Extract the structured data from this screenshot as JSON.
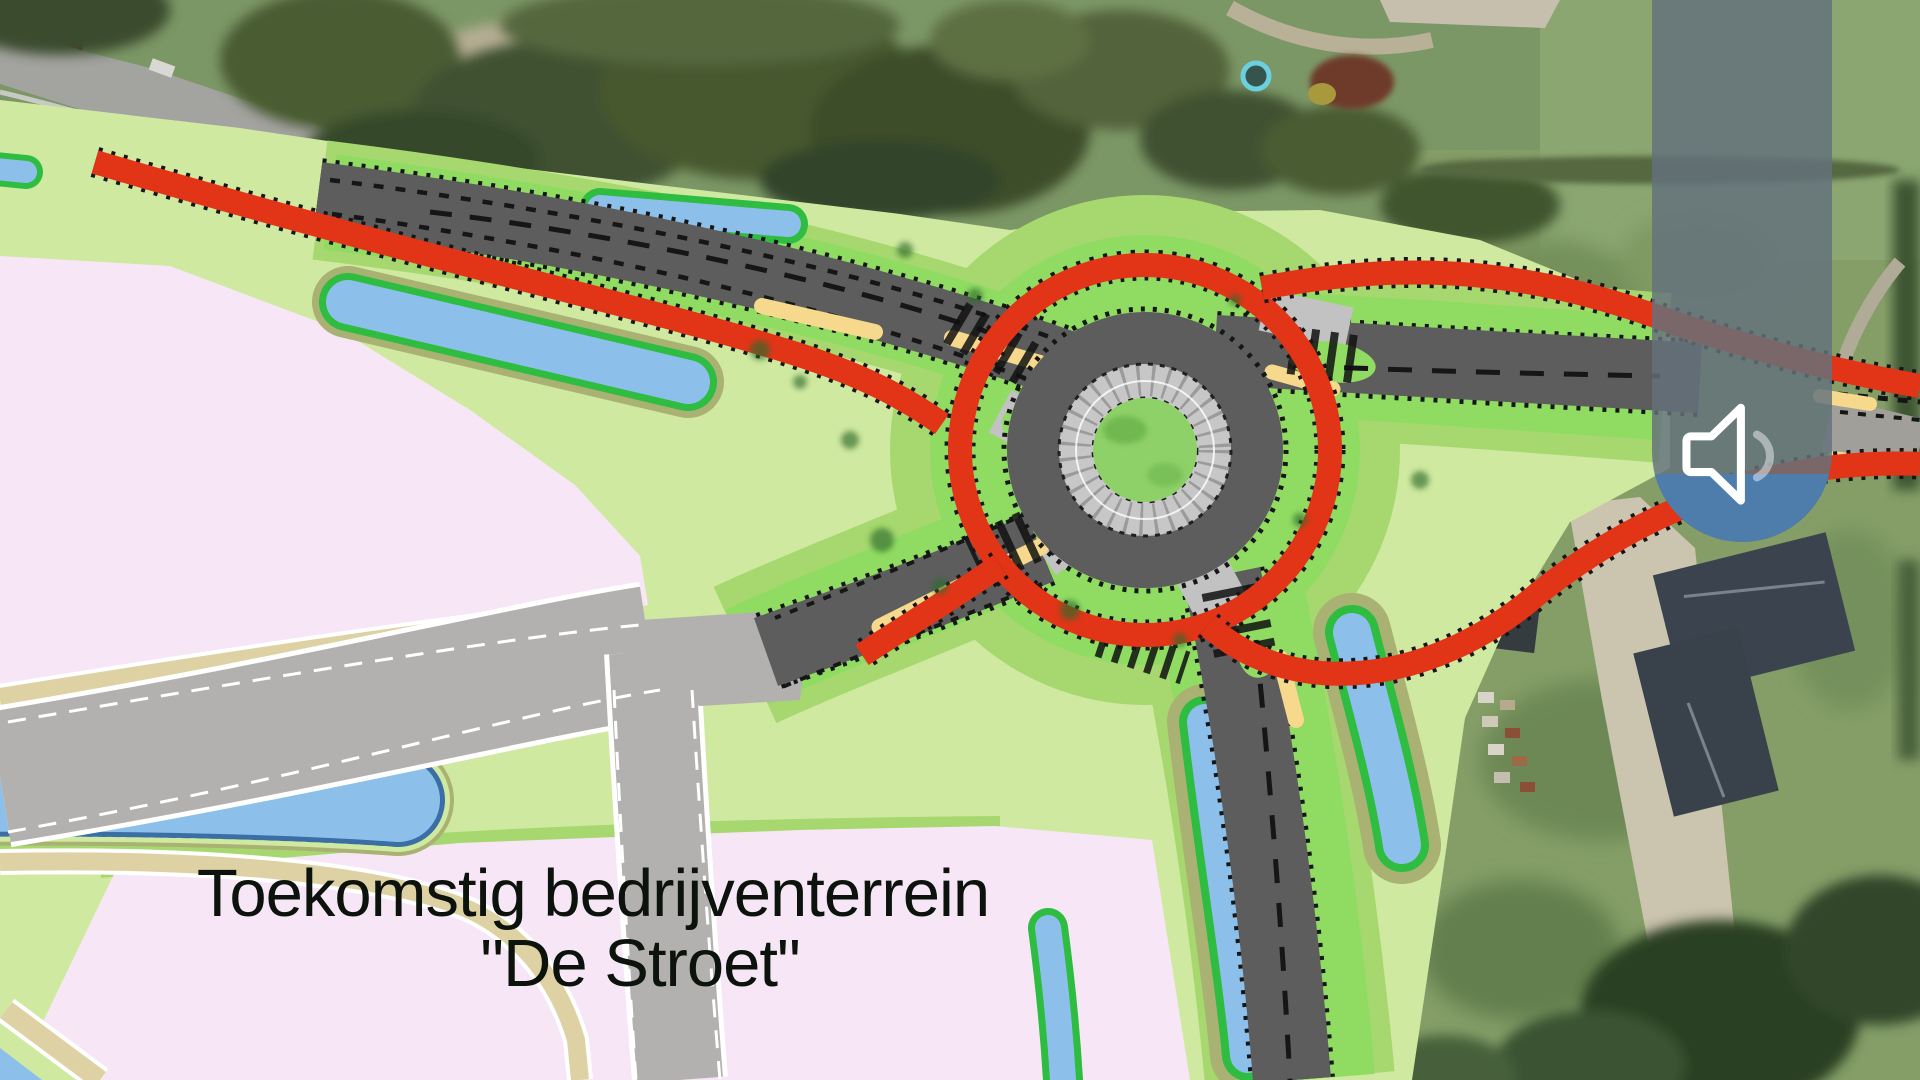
{
  "label": {
    "line1": "Toekomstig bedrijventerrein",
    "line2": "\"De Stroet\""
  },
  "volume_overlay": {
    "icon": "speaker-icon"
  },
  "palette": {
    "pink": "#f7e7f6",
    "plan_green_pale": "#cfe9a0",
    "plan_green_mid": "#a6d86f",
    "plan_green_bright": "#90dc63",
    "olive": "#a9b173",
    "red": "#e23517",
    "yellow": "#f6d98c",
    "asphalt": "#5d5d5d",
    "apron": "#c7c7c7",
    "apron_light": "#c2c2c2",
    "osm_gray": "#b3b1af",
    "beige": "#ded2a5",
    "water": "#8cc0ea",
    "water_border": "#2ebc41",
    "water_dash": "#3a6ea5",
    "island_green": "#8ed168",
    "label_color": "#0c120c",
    "zebra": "#101010",
    "mark_dark": "#161616",
    "overlay_track": "rgba(100,113,124,0.83)",
    "overlay_fill": "#4e7cab"
  }
}
